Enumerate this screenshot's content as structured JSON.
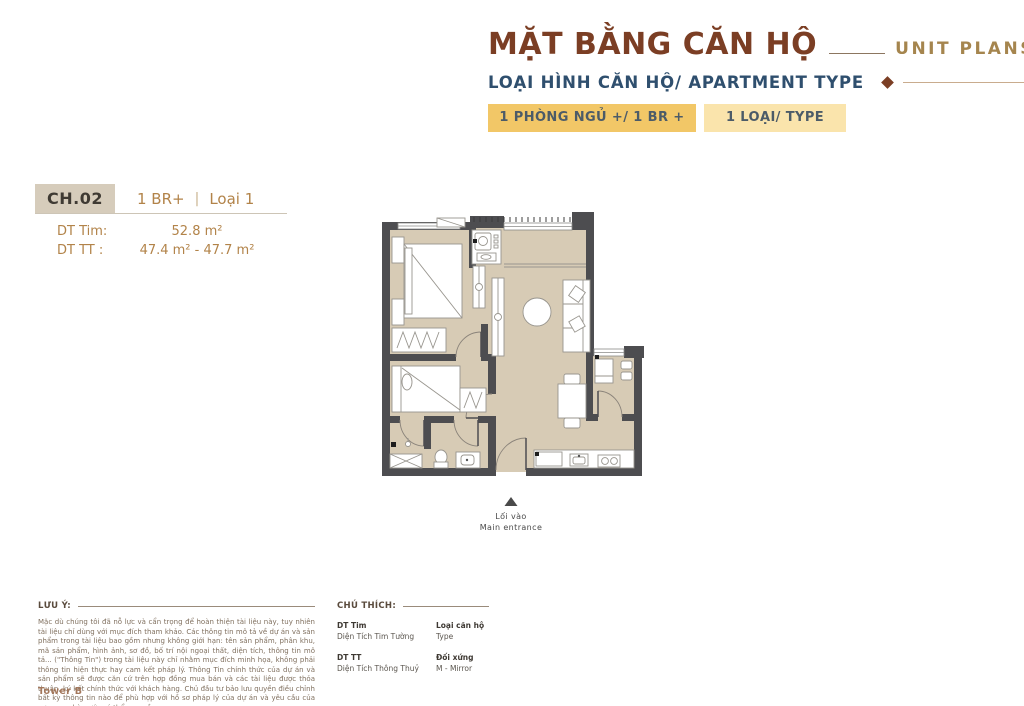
{
  "header": {
    "title": "MẶT BẰNG CĂN HỘ",
    "title_en": "UNIT PLANS",
    "subtitle": "LOẠI HÌNH CĂN HỘ/ APARTMENT TYPE",
    "badge_bedrooms": "1 PHÒNG NGỦ +/ 1 BR +",
    "badge_type": "1 LOẠI/ TYPE"
  },
  "unit": {
    "code": "CH.02",
    "category_left": "1 BR+",
    "category_sep": "|",
    "category_right": "Loại 1",
    "dt_tim_label": "DT Tim:",
    "dt_tim_value": "52.8 m²",
    "dt_tt_label": "DT TT :",
    "dt_tt_value": "47.4 m² - 47.7 m²"
  },
  "plan": {
    "entrance_vi": "Lối vào",
    "entrance_en": "Main entrance"
  },
  "notes": {
    "label": "LƯU Ý:",
    "body": "Mặc dù chúng tôi đã nỗ lực và cẩn trọng để hoàn thiện tài liệu này, tuy nhiên tài liệu chỉ dùng với mục đích tham khảo. Các thông tin mô tả về dự án và sản phẩm trong tài liệu bao gồm nhưng không giới hạn: tên sản phẩm, phân khu, mã sản phẩm, hình ảnh, sơ đồ, bố trí nội ngoại thất, diện tích, thông tin mô tả... (\"Thông Tin\") trong tài liệu này chỉ nhằm mục đích minh họa, không phải thông tin hiện thực hay cam kết pháp lý. Thông Tin chính thức của dự án và sản phẩm sẽ được căn cứ trên hợp đồng mua bán và các tài liệu được thỏa thuận, ký kết chính thức với khách hàng. Chủ đầu tư bảo lưu quyền điều chỉnh bất kỳ thông tin nào để phù hợp với hồ sơ pháp lý của dự án và yêu cầu của cơ quan nhà nước có thẩm quyền.",
    "tower": "Tower B"
  },
  "legend": {
    "label": "CHÚ THÍCH:",
    "items": [
      {
        "term": "DT Tim",
        "definition": "Diện Tích Tim Tường"
      },
      {
        "term": "Loại căn hộ",
        "definition": "Type"
      },
      {
        "term": "DT TT",
        "definition": "Diện Tích Thông Thuỷ"
      },
      {
        "term": "Đối xứng",
        "definition": "M - Mirror"
      }
    ]
  },
  "colors": {
    "accent_brown": "#7B3E24",
    "gold_text": "#B28349",
    "navy": "#2F4F6E",
    "badge_primary_bg": "#F2C767",
    "badge_secondary_bg": "#FAE4AC",
    "unit_code_bg": "#D6CCBB",
    "floor": "#D7CBB5",
    "wall": "#4D4D50"
  }
}
